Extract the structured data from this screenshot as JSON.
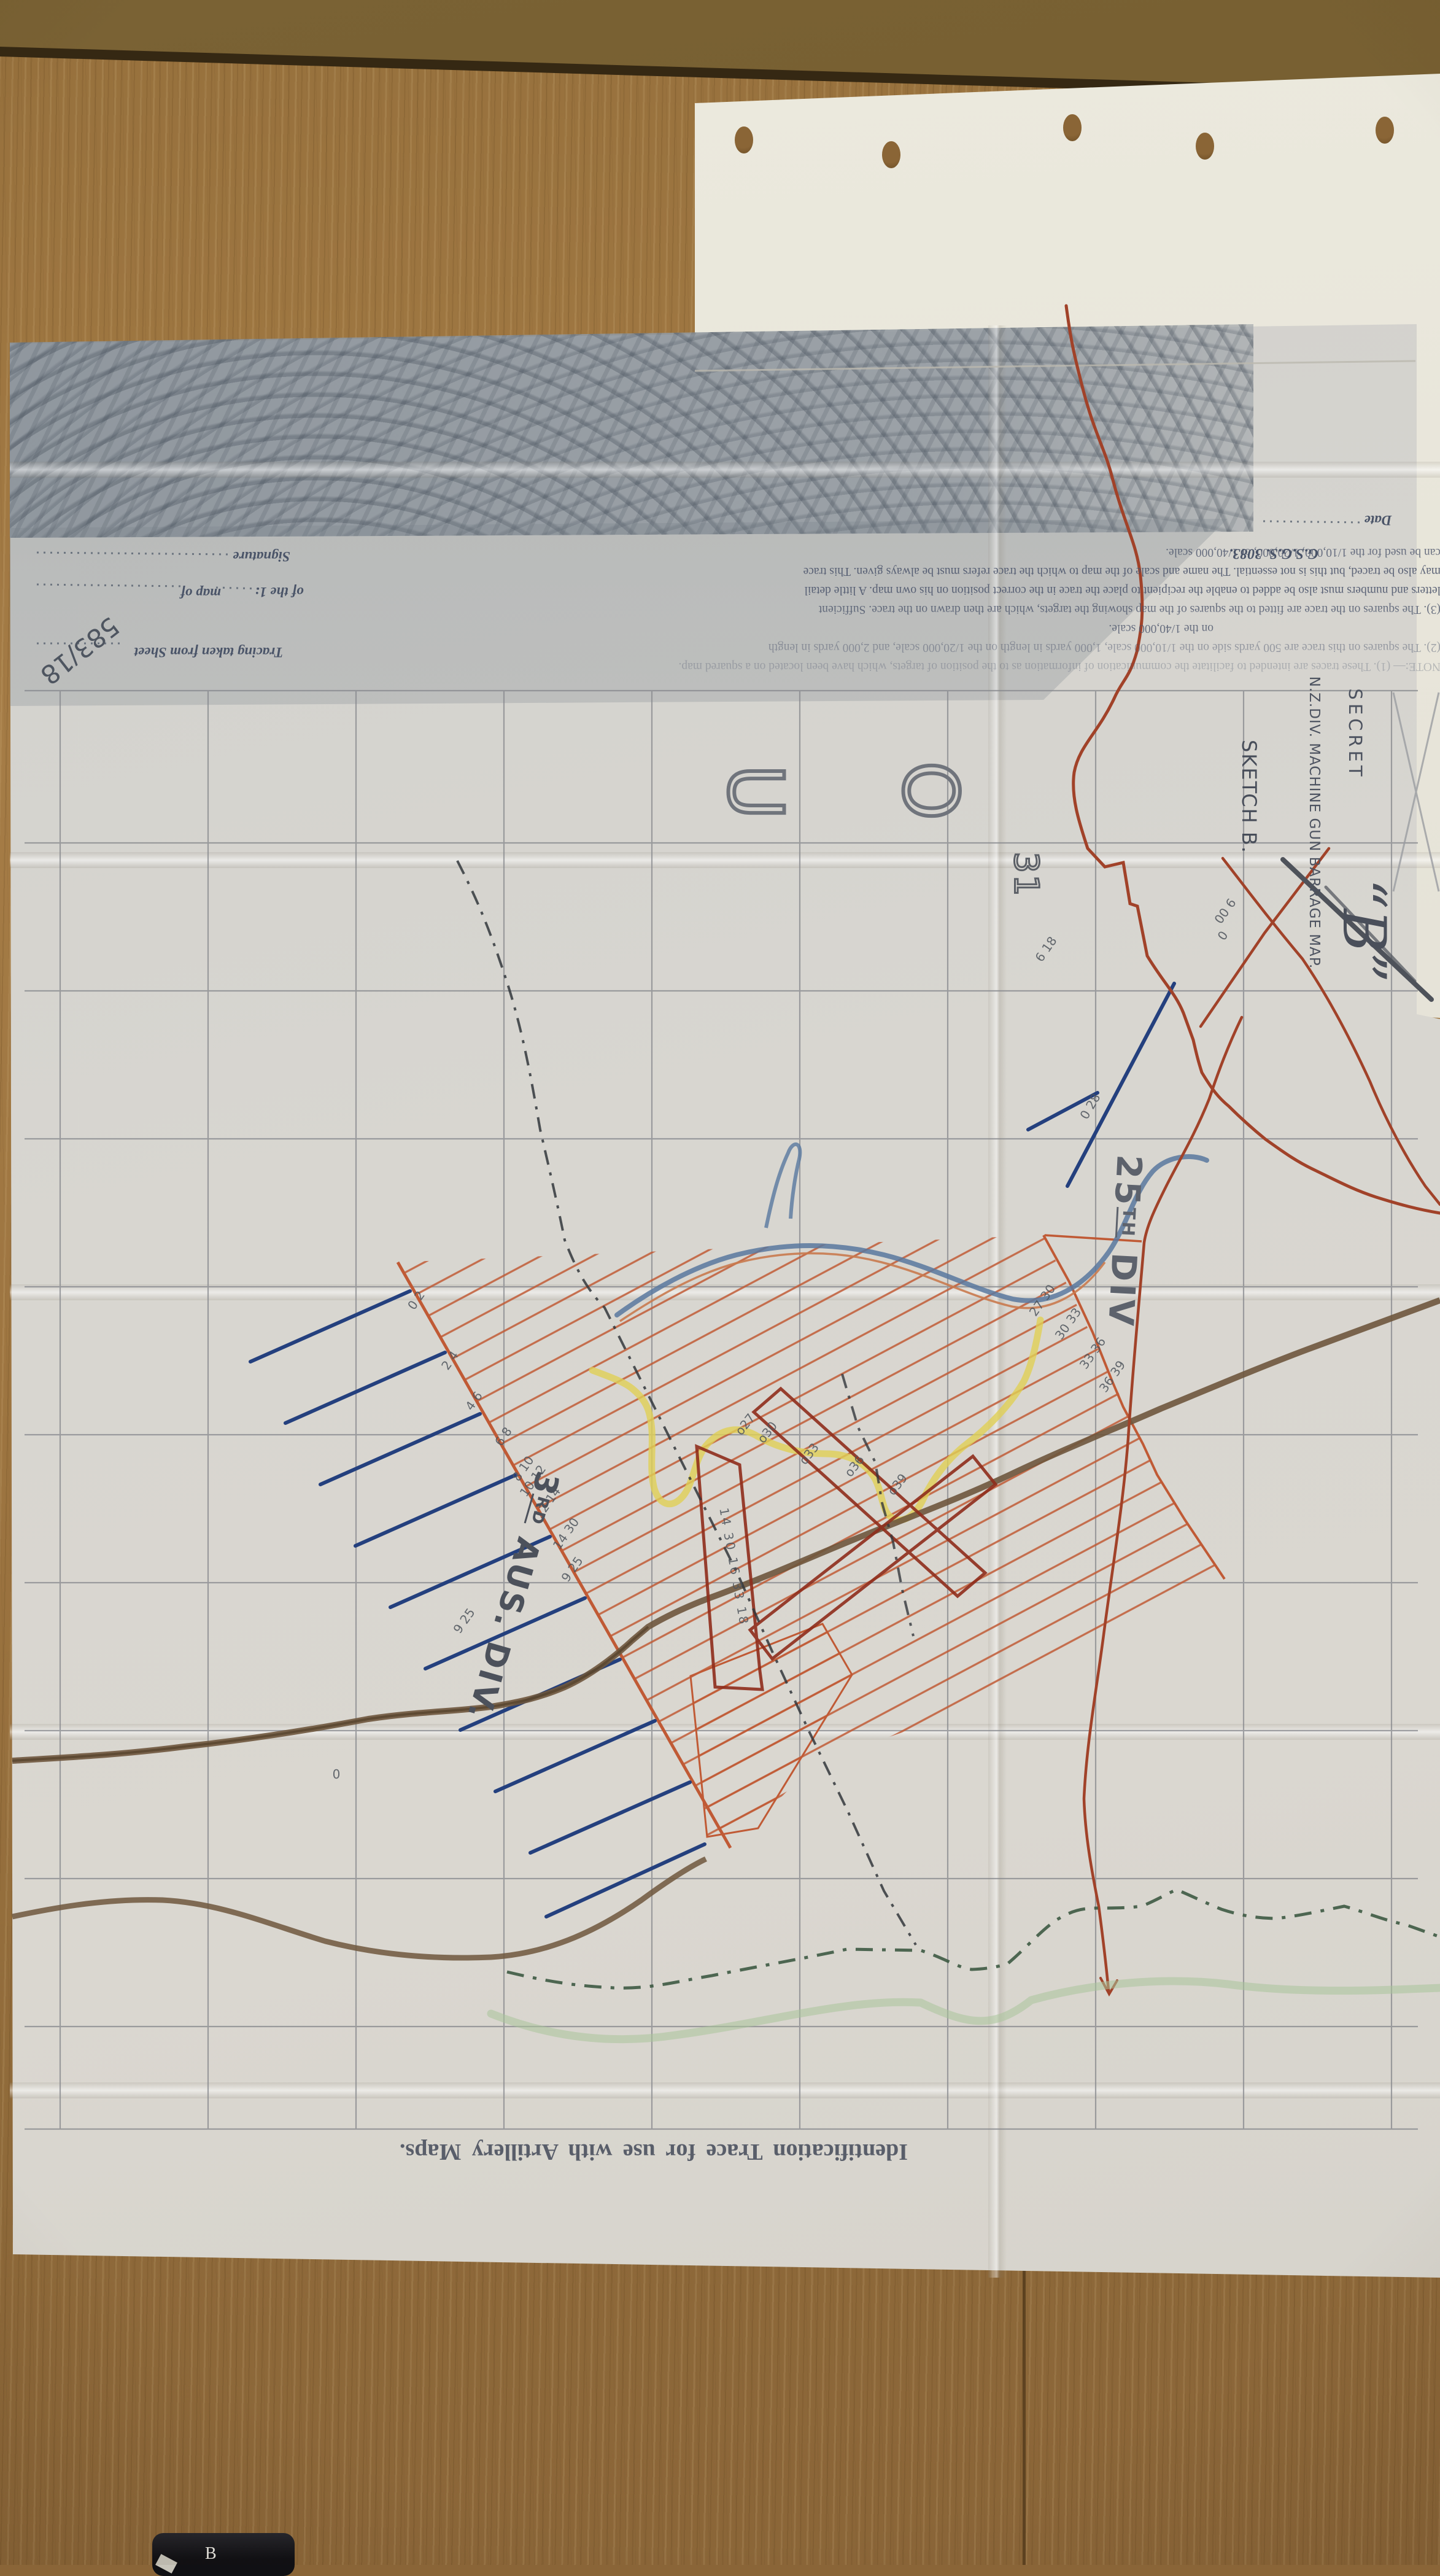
{
  "labels": {
    "secret": "SECRET",
    "title": "N.Z.DIV. MACHINE GUN BARRAGE MAP.",
    "sketch": "SKETCH B.",
    "b_mark": "“B”",
    "div25": {
      "num": "25",
      "sup": "TH",
      "word": "DIV"
    },
    "div3": {
      "num": "3",
      "sup": "RD",
      "word": "AUS. DIV."
    },
    "identification": "Identification Trace for use with Artillery Maps."
  },
  "form": {
    "note_lines": [
      "NOTE:— (1). These traces are intended to facilitate the communication of information as to the position of targets, which have been located on a squared map.",
      "(2). The squares on this trace are 500 yards side on the 1/10,000 scale, 1,000 yards in length on the 1/20,000 scale, and 2,000 yards in length",
      "on the 1/40,000 scale.",
      "(3). The squares on the trace are fitted to the squares of the map showing the targets, which are then drawn on the trace.  Sufficient",
      "letters and numbers must also be added to enable the recipient to place the trace in the correct position on his own map.  A little detail",
      "may also be traced, but this is not essential.  The name and scale of the map to which the trace refers must be always given.  This trace",
      "can be used for the 1/10,000, 1/20,000, or 1/40,000 scale."
    ],
    "gsgs": "G.S.G.S. 3083.",
    "tracing": "Tracing taken from Sheet",
    "of_the": "of the 1:",
    "map_of": "map of",
    "signature": "Signature",
    "date": "Date",
    "ref": "583/18"
  },
  "grid_marks": {
    "letter1": "U",
    "letter2": "O",
    "number": "31"
  },
  "annotations": {
    "fan": [
      "0 2",
      "2 4",
      "4 6",
      "6 8",
      "8 10",
      "10 12",
      "12 14",
      "14 30",
      "9 25",
      "9 25"
    ],
    "boundary": [
      "27 30",
      "30 33",
      "33 36",
      "36 39"
    ],
    "boxes": [
      "o27",
      "o30",
      "o33",
      "o36",
      "o39"
    ],
    "strip": "14 30 16 33 18",
    "line25": "0  28",
    "cross": "00  6",
    "cross2": "0",
    "jag": "6 18",
    "small_o": "0"
  },
  "object": {
    "letter": "B"
  },
  "colors": {
    "barrage_orange": "#c05a35",
    "box_red": "#8f2d1c",
    "blue_line": "#24407e",
    "yellow_route": "#e0cf55",
    "road_brown": "#6e573d",
    "green_dash": "#3d5a42",
    "light_green": "#a9c49a",
    "pencil_grid": "#85878c",
    "ink": "#4c5260"
  }
}
